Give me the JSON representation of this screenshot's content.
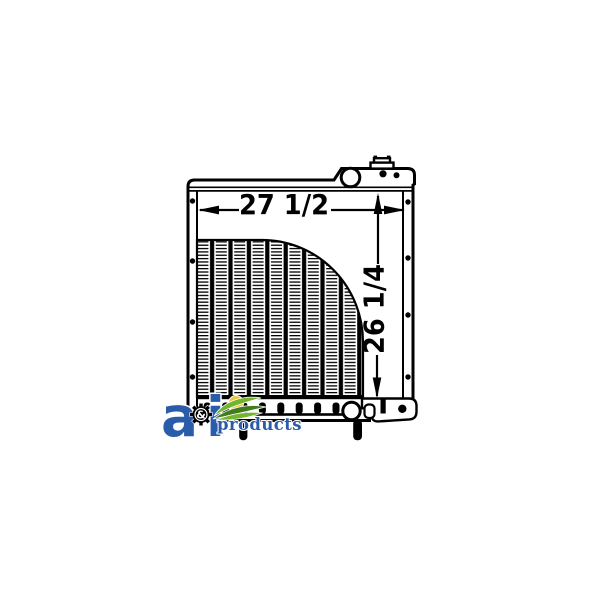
{
  "drawing": {
    "description": "Radiator technical line drawing",
    "background": "#ffffff",
    "line_color": "#000000",
    "dimensions": {
      "width_label": "27 1/2",
      "height_label": "26 1/4"
    }
  },
  "logo": {
    "letter_a": "a",
    "ampersand": "&",
    "letter_i": "i",
    "products_text": "products",
    "blue": "#2b5caa",
    "green_light": "#74b42e",
    "green_dark": "#3f7d1f",
    "yellow": "#eac73c",
    "black": "#000000",
    "white": "#ffffff"
  }
}
